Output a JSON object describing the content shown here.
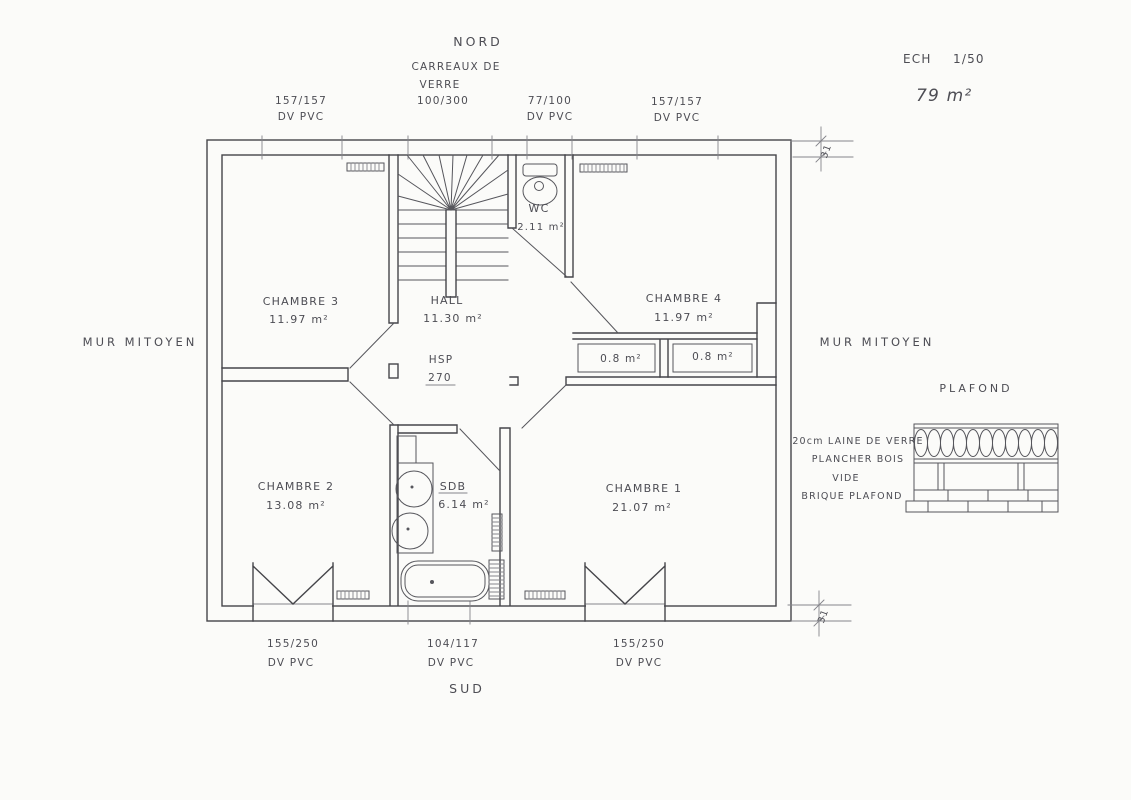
{
  "plan": {
    "north_label": "NORD",
    "south_label": "SUD",
    "scale_prefix": "ECH",
    "scale_value": "1/50",
    "total_area": "79 m²",
    "party_wall_left": "MUR MITOYEN",
    "party_wall_right": "MUR MITOYEN",
    "glass_block_line1": "CARREAUX DE",
    "glass_block_line2": "VERRE",
    "ceiling_height_label": "HSP",
    "ceiling_height_value": "270",
    "wall_thickness_top": "31",
    "wall_thickness_bottom": "31"
  },
  "windows": {
    "top_left_size": "157/157",
    "top_left_type": "DV PVC",
    "top_glass_size": "100/300",
    "top_mid_size": "77/100",
    "top_mid_type": "DV PVC",
    "top_right_size": "157/157",
    "top_right_type": "DV PVC",
    "bottom_left_size": "155/250",
    "bottom_left_type": "DV PVC",
    "bottom_mid_size": "104/117",
    "bottom_mid_type": "DV PVC",
    "bottom_right_size": "155/250",
    "bottom_right_type": "DV PVC"
  },
  "rooms": {
    "chambre3_name": "CHAMBRE 3",
    "chambre3_area": "11.97 m²",
    "hall_name": "HALL",
    "hall_area": "11.30 m²",
    "wc_name": "WC",
    "wc_area": "2.11 m²",
    "chambre4_name": "CHAMBRE 4",
    "chambre4_area": "11.97 m²",
    "closet_left_area": "0.8 m²",
    "closet_right_area": "0.8 m²",
    "chambre2_name": "CHAMBRE 2",
    "chambre2_area": "13.08 m²",
    "sdb_name": "SDB",
    "sdb_area": "6.14 m²",
    "chambre1_name": "CHAMBRE 1",
    "chambre1_area": "21.07 m²"
  },
  "ceiling_detail": {
    "title": "PLAFOND",
    "layers": [
      "20cm LAINE DE VERRE",
      "PLANCHER BOIS",
      "VIDE",
      "BRIQUE PLAFOND"
    ]
  }
}
